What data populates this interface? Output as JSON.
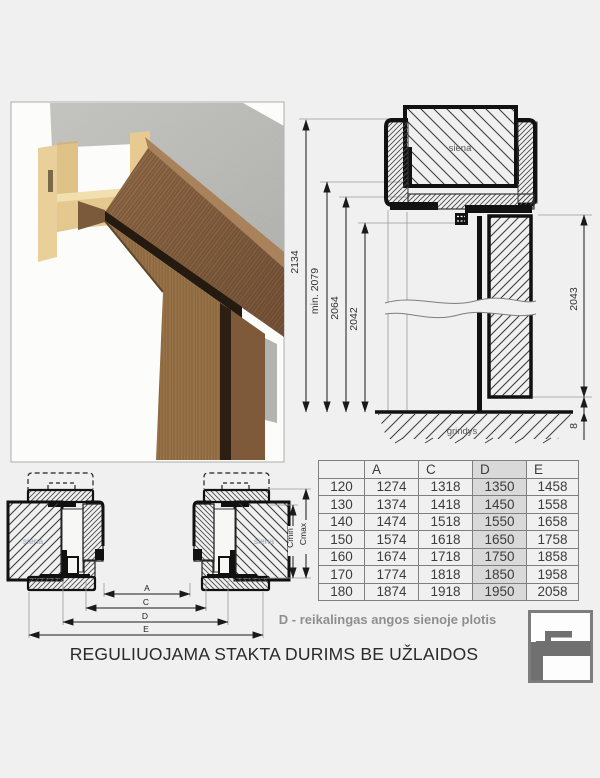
{
  "title": "REGULIUOJAMA STAKTA DURIMS BE UŽLAIDOS",
  "note": "D - reikalingas angos sienoje plotis",
  "top_drawing": {
    "wall_label": "siena",
    "floor_label": "grindys",
    "dim_total_height": "2134",
    "dim_min_height": "min. 2079",
    "dim_frame_height": "2064",
    "dim_opening_height": "2042",
    "dim_leaf_height": "2043",
    "dim_floor_gap": "8"
  },
  "bottom_drawing": {
    "wall_label_left": "siena",
    "wall_label_right": "siena",
    "dim_a": "A",
    "dim_c": "C",
    "dim_d": "D",
    "dim_e": "E",
    "dim_cmin": "Cmin",
    "dim_cmax": "Cmax"
  },
  "table": {
    "headers": [
      "",
      "A",
      "C",
      "D",
      "E"
    ],
    "highlighted_column": "D",
    "highlight_color": "#d9d9d9",
    "rows": [
      [
        "120",
        "1274",
        "1318",
        "1350",
        "1458"
      ],
      [
        "130",
        "1374",
        "1418",
        "1450",
        "1558"
      ],
      [
        "140",
        "1474",
        "1518",
        "1550",
        "1658"
      ],
      [
        "150",
        "1574",
        "1618",
        "1650",
        "1758"
      ],
      [
        "160",
        "1674",
        "1718",
        "1750",
        "1858"
      ],
      [
        "170",
        "1774",
        "1818",
        "1850",
        "1958"
      ],
      [
        "180",
        "1874",
        "1918",
        "1950",
        "2058"
      ]
    ]
  },
  "colors": {
    "page_bg": "#f0f0f0",
    "line": "#1a1a1a",
    "dim_text": "#333333",
    "table_highlight": "#d9d9d9",
    "note_gray": "#8e8e8e",
    "logo_gray": "#707070",
    "wood": "#8d6746",
    "mdf_beige": "#e4c88e",
    "concrete": "#bcbcb8"
  }
}
